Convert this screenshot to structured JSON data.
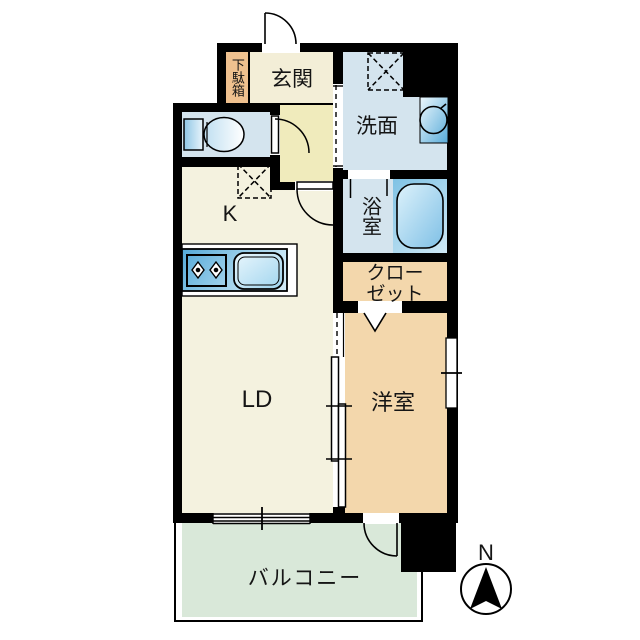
{
  "floorplan": {
    "rooms": {
      "getabako": "下駄箱",
      "genkan": "玄関",
      "senmen": "洗面",
      "yokushitsu": "浴室",
      "closet": "クロー\nゼット",
      "kitchen": "K",
      "living_dining": "LD",
      "western_room": "洋室",
      "balcony": "バルコニー"
    },
    "compass": {
      "north_label": "N"
    },
    "fixtures": [
      "entrance-door",
      "shoe-cabinet",
      "toilet",
      "wash-basin",
      "washing-machine-pan",
      "bathtub",
      "kitchen-counter",
      "stove-burners",
      "kitchen-sink",
      "closet-folding-door",
      "sliding-partition",
      "balcony-sliding-window",
      "balcony-door",
      "western-room-window"
    ],
    "colors": {
      "wall": "#000000",
      "entrance": "#f3eed7",
      "hallway": "#f0ebbc",
      "wet_area": "#d4e4ee",
      "kitchen_living": "#f4f2df",
      "western_room": "#f3d7ac",
      "shoe_cabinet": "#efc18f",
      "balcony": "#d9e8d9",
      "fixture_blue": "#5fb0da"
    }
  }
}
